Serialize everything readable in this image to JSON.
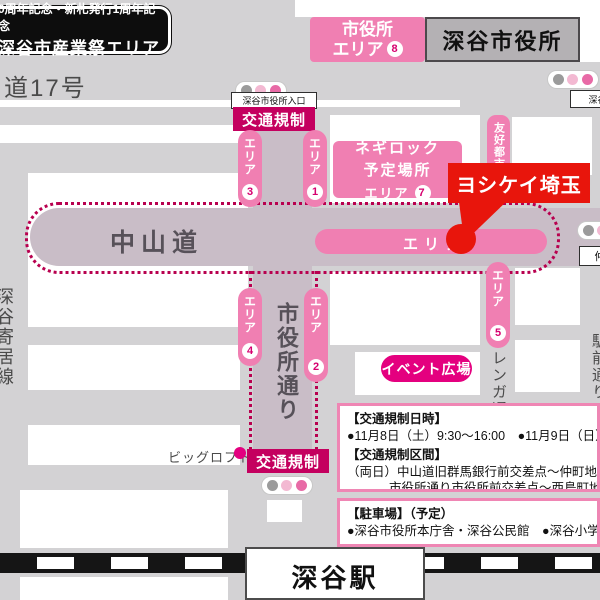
{
  "colors": {
    "pink": "#f07fb2",
    "deep_magenta": "#c4005f",
    "event_magenta": "#e4007f",
    "red": "#e8150c",
    "road_mauve": "#c9bdc7",
    "dotted_border": "#b8004f",
    "background_gray": "#d3d2d4"
  },
  "badge": {
    "line1": "0周年記念・新札発行1周年記念",
    "line2": "深谷市産業祭エリア"
  },
  "roads": {
    "route17": "道17号",
    "nakasendo": "中山道",
    "shiyakusho_dori": "市役所通り",
    "fukaya_yorii_sen": "深谷寄居線",
    "renga_dori": "レンガ通り",
    "ekimae_dori": "駅前通り"
  },
  "city_hall_area": {
    "line1": "市役所",
    "line2": "エリア",
    "number": "8"
  },
  "city_hall": {
    "label": "深谷市役所"
  },
  "signals": {
    "city_hall_entrance": "深谷市役所入口",
    "fukaya_station": "深谷駅",
    "naka": "仲"
  },
  "traffic_regulation": {
    "label": "交通規制"
  },
  "areas": {
    "label": "エリア",
    "n1": "1",
    "n2": "2",
    "n3": "3",
    "n4": "4",
    "n5": "5"
  },
  "area_bar": {
    "label": "エリア"
  },
  "friendship": {
    "label": "友好都市"
  },
  "negi_rock": {
    "line1": "ネギロック",
    "line2": "予定場所",
    "area_label": "エリア",
    "number": "7"
  },
  "yoshikei": {
    "label": "ヨシケイ埼玉"
  },
  "event_plaza": {
    "label": "イベント広場"
  },
  "big_loft": {
    "label": "ビッグロフト"
  },
  "info_regulation": {
    "heading1": "【交通規制日時】",
    "line1": "●11月8日（土）9:30～16:00　●11月9日（日）9:",
    "heading2": "【交通規制区間】",
    "line2": "（両日）中山道旧群馬銀行前交差点～仲町地内駅",
    "line3": "市役所通り市役所前交差点～西島町地内"
  },
  "info_parking": {
    "heading": "【駐車場】（予定）",
    "line1": "●深谷市役所本庁舎・深谷公民館　●深谷小学校"
  },
  "station": {
    "label": "深谷駅"
  }
}
